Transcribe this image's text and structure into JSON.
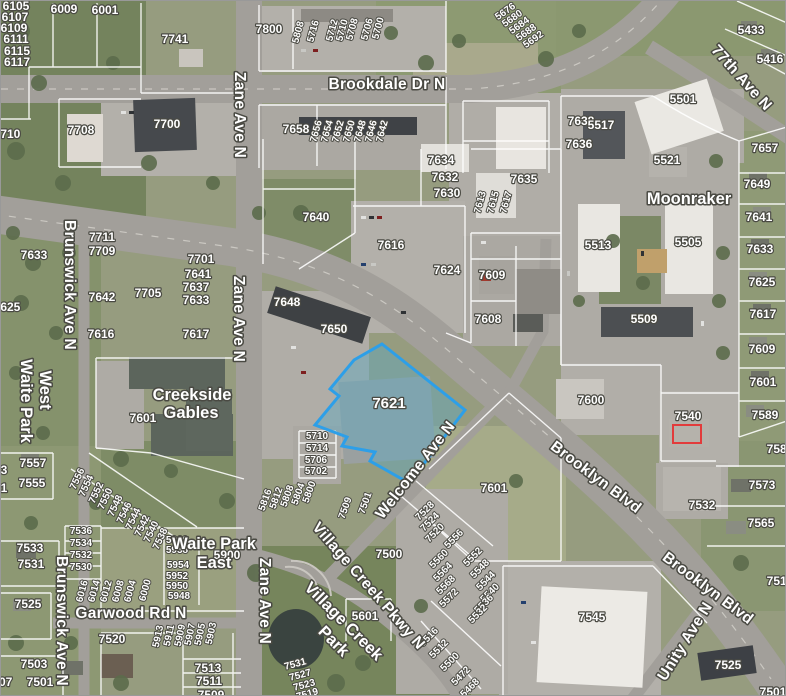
{
  "map": {
    "type": "aerial-parcel-map",
    "selected_parcel": {
      "id": "7621",
      "outline_color": "#2d9fe8",
      "fill_color": "#5fa8c0"
    },
    "red_outline": {
      "near_parcel": "7540",
      "color": "#e23b3b"
    },
    "colors": {
      "label_text": "#ffffff",
      "label_halo": "#4a4a43",
      "parcel_line": "#ffffff"
    },
    "street_labels": [
      {
        "t": "Brookdale Dr N",
        "x": 386,
        "y": 88,
        "r": 0
      },
      {
        "t": "Zane Ave N",
        "x": 234,
        "y": 114,
        "r": 90
      },
      {
        "t": "Zane Ave N",
        "x": 233,
        "y": 318,
        "r": 90
      },
      {
        "t": "Zane Ave N",
        "x": 259,
        "y": 600,
        "r": 90
      },
      {
        "t": "Brunswick Ave N",
        "x": 64,
        "y": 284,
        "r": 90
      },
      {
        "t": "Brunswick Ave N",
        "x": 56,
        "y": 620,
        "r": 90
      },
      {
        "t": "Brooklyn Blvd",
        "x": 592,
        "y": 480,
        "r": 37
      },
      {
        "t": "Brooklyn Blvd",
        "x": 704,
        "y": 591,
        "r": 37
      },
      {
        "t": "Welcome Ave N",
        "x": 418,
        "y": 472,
        "r": -52
      },
      {
        "t": "Village Creek Pkwy N",
        "x": 364,
        "y": 588,
        "r": 49
      },
      {
        "t": "Unity Ave N",
        "x": 688,
        "y": 643,
        "r": -58
      },
      {
        "t": "77th Ave N",
        "x": 737,
        "y": 80,
        "r": 48
      },
      {
        "t": "Garwood Rd N",
        "x": 130,
        "y": 617,
        "r": 0
      }
    ],
    "area_labels": [
      {
        "t": "Moonraker",
        "x": 688,
        "y": 203,
        "r": 0
      },
      {
        "t": "Creekside",
        "x": 191,
        "y": 399,
        "r": 0
      },
      {
        "t": "Gables",
        "x": 190,
        "y": 417,
        "r": 0
      },
      {
        "t": "Waite Park",
        "x": 20,
        "y": 400,
        "r": 90
      },
      {
        "t": "West",
        "x": 39,
        "y": 389,
        "r": 90
      },
      {
        "t": "Waite Park",
        "x": 213,
        "y": 548,
        "r": 0
      },
      {
        "t": "East",
        "x": 213,
        "y": 567,
        "r": 0
      },
      {
        "t": "Village Creek",
        "x": 339,
        "y": 624,
        "r": 45
      },
      {
        "t": "Park",
        "x": 329,
        "y": 644,
        "r": 45
      }
    ],
    "parcel_labels": [
      {
        "t": "6105",
        "x": 15,
        "y": 9
      },
      {
        "t": "6107",
        "x": 14,
        "y": 20
      },
      {
        "t": "6109",
        "x": 13,
        "y": 31
      },
      {
        "t": "6111",
        "x": 15,
        "y": 42
      },
      {
        "t": "6115",
        "x": 16,
        "y": 54
      },
      {
        "t": "6117",
        "x": 16,
        "y": 65
      },
      {
        "t": "6009",
        "x": 63,
        "y": 12
      },
      {
        "t": "6001",
        "x": 104,
        "y": 13
      },
      {
        "t": "7741",
        "x": 174,
        "y": 42
      },
      {
        "t": "7800",
        "x": 268,
        "y": 32
      },
      {
        "t": "5808",
        "x": 300,
        "y": 32,
        "r": -75,
        "sm": true
      },
      {
        "t": "5716",
        "x": 315,
        "y": 31,
        "r": -75,
        "sm": true
      },
      {
        "t": "5712",
        "x": 334,
        "y": 30,
        "r": -75,
        "sm": true
      },
      {
        "t": "5710",
        "x": 344,
        "y": 30,
        "r": -75,
        "sm": true
      },
      {
        "t": "5708",
        "x": 354,
        "y": 29,
        "r": -75,
        "sm": true
      },
      {
        "t": "5706",
        "x": 369,
        "y": 29,
        "r": -75,
        "sm": true
      },
      {
        "t": "5700",
        "x": 380,
        "y": 28,
        "r": -75,
        "sm": true
      },
      {
        "t": "5676",
        "x": 506,
        "y": 13,
        "r": -35,
        "sm": true
      },
      {
        "t": "5680",
        "x": 513,
        "y": 20,
        "r": -35,
        "sm": true
      },
      {
        "t": "5684",
        "x": 520,
        "y": 27,
        "r": -35,
        "sm": true
      },
      {
        "t": "5688",
        "x": 527,
        "y": 34,
        "r": -35,
        "sm": true
      },
      {
        "t": "5692",
        "x": 534,
        "y": 41,
        "r": -35,
        "sm": true
      },
      {
        "t": "5433",
        "x": 750,
        "y": 33
      },
      {
        "t": "5416",
        "x": 769,
        "y": 62
      },
      {
        "t": "7708",
        "x": 80,
        "y": 133
      },
      {
        "t": "7710",
        "x": 6,
        "y": 137
      },
      {
        "t": "7700",
        "x": 166,
        "y": 127
      },
      {
        "t": "7658",
        "x": 295,
        "y": 132
      },
      {
        "t": "7656",
        "x": 318,
        "y": 131,
        "r": -75,
        "sm": true
      },
      {
        "t": "7654",
        "x": 329,
        "y": 131,
        "r": -75,
        "sm": true
      },
      {
        "t": "7652",
        "x": 340,
        "y": 131,
        "r": -75,
        "sm": true
      },
      {
        "t": "7650",
        "x": 351,
        "y": 131,
        "r": -75,
        "sm": true
      },
      {
        "t": "7648",
        "x": 362,
        "y": 131,
        "r": -75,
        "sm": true
      },
      {
        "t": "7646",
        "x": 373,
        "y": 131,
        "r": -75,
        "sm": true
      },
      {
        "t": "7642",
        "x": 384,
        "y": 131,
        "r": -75,
        "sm": true
      },
      {
        "t": "7638",
        "x": 580,
        "y": 124
      },
      {
        "t": "7636",
        "x": 578,
        "y": 147
      },
      {
        "t": "7634",
        "x": 440,
        "y": 163
      },
      {
        "t": "7632",
        "x": 444,
        "y": 180
      },
      {
        "t": "7630",
        "x": 446,
        "y": 196
      },
      {
        "t": "7635",
        "x": 523,
        "y": 182
      },
      {
        "t": "7613",
        "x": 482,
        "y": 202,
        "r": -75,
        "sm": true
      },
      {
        "t": "7615",
        "x": 495,
        "y": 202,
        "r": -75,
        "sm": true
      },
      {
        "t": "7617",
        "x": 508,
        "y": 202,
        "r": -75,
        "sm": true
      },
      {
        "t": "7640",
        "x": 315,
        "y": 220
      },
      {
        "t": "7616",
        "x": 390,
        "y": 248
      },
      {
        "t": "7624",
        "x": 446,
        "y": 273
      },
      {
        "t": "7609",
        "x": 491,
        "y": 278
      },
      {
        "t": "7608",
        "x": 487,
        "y": 322
      },
      {
        "t": "7648",
        "x": 286,
        "y": 305
      },
      {
        "t": "7650",
        "x": 333,
        "y": 332
      },
      {
        "t": "5501",
        "x": 682,
        "y": 102
      },
      {
        "t": "5517",
        "x": 600,
        "y": 128
      },
      {
        "t": "5521",
        "x": 666,
        "y": 163
      },
      {
        "t": "5513",
        "x": 597,
        "y": 248
      },
      {
        "t": "5505",
        "x": 687,
        "y": 245
      },
      {
        "t": "5509",
        "x": 643,
        "y": 322
      },
      {
        "t": "7657",
        "x": 764,
        "y": 151
      },
      {
        "t": "7649",
        "x": 756,
        "y": 187
      },
      {
        "t": "7641",
        "x": 758,
        "y": 220
      },
      {
        "t": "7633",
        "x": 759,
        "y": 252
      },
      {
        "t": "7625",
        "x": 761,
        "y": 285
      },
      {
        "t": "7617",
        "x": 762,
        "y": 317
      },
      {
        "t": "7609",
        "x": 761,
        "y": 352
      },
      {
        "t": "7601",
        "x": 762,
        "y": 385
      },
      {
        "t": "7589",
        "x": 764,
        "y": 418
      },
      {
        "t": "7581",
        "x": 779,
        "y": 452
      },
      {
        "t": "7573",
        "x": 761,
        "y": 488
      },
      {
        "t": "7565",
        "x": 760,
        "y": 526
      },
      {
        "t": "7517",
        "x": 779,
        "y": 584
      },
      {
        "t": "7600",
        "x": 590,
        "y": 403
      },
      {
        "t": "7540",
        "x": 687,
        "y": 419
      },
      {
        "t": "7711",
        "x": 101,
        "y": 240
      },
      {
        "t": "7709",
        "x": 101,
        "y": 254
      },
      {
        "t": "7642",
        "x": 101,
        "y": 300
      },
      {
        "t": "7705",
        "x": 147,
        "y": 296
      },
      {
        "t": "7616",
        "x": 100,
        "y": 337
      },
      {
        "t": "7701",
        "x": 200,
        "y": 262
      },
      {
        "t": "7641",
        "x": 197,
        "y": 277
      },
      {
        "t": "7637",
        "x": 195,
        "y": 290
      },
      {
        "t": "7633",
        "x": 195,
        "y": 303
      },
      {
        "t": "7617",
        "x": 195,
        "y": 337
      },
      {
        "t": "7633",
        "x": 33,
        "y": 258
      },
      {
        "t": "7625",
        "x": 6,
        "y": 310
      },
      {
        "t": "7557",
        "x": 32,
        "y": 466
      },
      {
        "t": "7555",
        "x": 31,
        "y": 486
      },
      {
        "t": "7553",
        "x": -7,
        "y": 473
      },
      {
        "t": "7551",
        "x": -7,
        "y": 491
      },
      {
        "t": "7601",
        "x": 142,
        "y": 421
      },
      {
        "t": "7556",
        "x": 79,
        "y": 479,
        "r": -65,
        "sm": true
      },
      {
        "t": "7554",
        "x": 88,
        "y": 486,
        "r": -65,
        "sm": true
      },
      {
        "t": "7552",
        "x": 98,
        "y": 493,
        "r": -65,
        "sm": true
      },
      {
        "t": "7550",
        "x": 107,
        "y": 499,
        "r": -65,
        "sm": true
      },
      {
        "t": "7548",
        "x": 117,
        "y": 506,
        "r": -65,
        "sm": true
      },
      {
        "t": "7546",
        "x": 126,
        "y": 513,
        "r": -65,
        "sm": true
      },
      {
        "t": "7544",
        "x": 135,
        "y": 519,
        "r": -65,
        "sm": true
      },
      {
        "t": "7542",
        "x": 144,
        "y": 526,
        "r": -65,
        "sm": true
      },
      {
        "t": "7540",
        "x": 153,
        "y": 532,
        "r": -65,
        "sm": true
      },
      {
        "t": "7538",
        "x": 162,
        "y": 539,
        "r": -65,
        "sm": true
      },
      {
        "t": "7536",
        "x": 80,
        "y": 533,
        "sm": true
      },
      {
        "t": "7534",
        "x": 80,
        "y": 545,
        "sm": true
      },
      {
        "t": "7532",
        "x": 80,
        "y": 557,
        "sm": true
      },
      {
        "t": "7530",
        "x": 80,
        "y": 569,
        "sm": true
      },
      {
        "t": "7533",
        "x": 29,
        "y": 551
      },
      {
        "t": "7531",
        "x": 30,
        "y": 567
      },
      {
        "t": "7525",
        "x": 27,
        "y": 607
      },
      {
        "t": "7503",
        "x": 33,
        "y": 667
      },
      {
        "t": "7501",
        "x": 39,
        "y": 685
      },
      {
        "t": "7507",
        "x": -2,
        "y": 685
      },
      {
        "t": "5960",
        "x": 176,
        "y": 542,
        "sm": true
      },
      {
        "t": "5958",
        "x": 176,
        "y": 552,
        "sm": true
      },
      {
        "t": "5954",
        "x": 177,
        "y": 567,
        "sm": true
      },
      {
        "t": "5952",
        "x": 176,
        "y": 578,
        "sm": true
      },
      {
        "t": "5950",
        "x": 176,
        "y": 588,
        "sm": true
      },
      {
        "t": "5948",
        "x": 178,
        "y": 598,
        "sm": true
      },
      {
        "t": "5900",
        "x": 226,
        "y": 558
      },
      {
        "t": "6016",
        "x": 84,
        "y": 591,
        "r": -75,
        "sm": true
      },
      {
        "t": "6014",
        "x": 96,
        "y": 591,
        "r": -75,
        "sm": true
      },
      {
        "t": "6012",
        "x": 108,
        "y": 591,
        "r": -75,
        "sm": true
      },
      {
        "t": "6008",
        "x": 120,
        "y": 591,
        "r": -75,
        "sm": true
      },
      {
        "t": "6004",
        "x": 132,
        "y": 591,
        "r": -75,
        "sm": true
      },
      {
        "t": "6000",
        "x": 147,
        "y": 590,
        "r": -75,
        "sm": true
      },
      {
        "t": "5913",
        "x": 160,
        "y": 636,
        "r": -78,
        "sm": true
      },
      {
        "t": "5911",
        "x": 171,
        "y": 635,
        "r": -78,
        "sm": true
      },
      {
        "t": "5909",
        "x": 182,
        "y": 635,
        "r": -78,
        "sm": true
      },
      {
        "t": "5907",
        "x": 192,
        "y": 634,
        "r": -78,
        "sm": true
      },
      {
        "t": "5905",
        "x": 202,
        "y": 634,
        "r": -78,
        "sm": true
      },
      {
        "t": "5903",
        "x": 213,
        "y": 633,
        "r": -78,
        "sm": true
      },
      {
        "t": "7520",
        "x": 111,
        "y": 642
      },
      {
        "t": "7513",
        "x": 207,
        "y": 671
      },
      {
        "t": "7511",
        "x": 208,
        "y": 684
      },
      {
        "t": "7509",
        "x": 210,
        "y": 698
      },
      {
        "t": "5816",
        "x": 267,
        "y": 500,
        "r": -70,
        "sm": true
      },
      {
        "t": "5812",
        "x": 278,
        "y": 498,
        "r": -70,
        "sm": true
      },
      {
        "t": "5808",
        "x": 289,
        "y": 496,
        "r": -70,
        "sm": true
      },
      {
        "t": "5804",
        "x": 300,
        "y": 494,
        "r": -70,
        "sm": true
      },
      {
        "t": "5800",
        "x": 311,
        "y": 492,
        "r": -70,
        "sm": true
      },
      {
        "t": "7509",
        "x": 347,
        "y": 508,
        "r": -70,
        "sm": true
      },
      {
        "t": "7501",
        "x": 367,
        "y": 503,
        "r": -70,
        "sm": true
      },
      {
        "t": "7500",
        "x": 388,
        "y": 557
      },
      {
        "t": "7528",
        "x": 426,
        "y": 512,
        "r": -45,
        "sm": true
      },
      {
        "t": "7524",
        "x": 431,
        "y": 523,
        "r": -45,
        "sm": true
      },
      {
        "t": "7520",
        "x": 436,
        "y": 534,
        "r": -45,
        "sm": true
      },
      {
        "t": "5560",
        "x": 440,
        "y": 560,
        "r": -45,
        "sm": true
      },
      {
        "t": "5564",
        "x": 444,
        "y": 573,
        "r": -45,
        "sm": true
      },
      {
        "t": "5568",
        "x": 447,
        "y": 586,
        "r": -45,
        "sm": true
      },
      {
        "t": "5572",
        "x": 450,
        "y": 599,
        "r": -45,
        "sm": true
      },
      {
        "t": "5556",
        "x": 455,
        "y": 540,
        "r": -45,
        "sm": true
      },
      {
        "t": "5552",
        "x": 474,
        "y": 558,
        "r": -45,
        "sm": true
      },
      {
        "t": "5548",
        "x": 481,
        "y": 570,
        "r": -45,
        "sm": true
      },
      {
        "t": "5544",
        "x": 487,
        "y": 582,
        "r": -45,
        "sm": true
      },
      {
        "t": "5540",
        "x": 491,
        "y": 594,
        "r": -45,
        "sm": true
      },
      {
        "t": "5536",
        "x": 485,
        "y": 605,
        "r": -45,
        "sm": true
      },
      {
        "t": "5532",
        "x": 479,
        "y": 615,
        "r": -45,
        "sm": true
      },
      {
        "t": "5516",
        "x": 430,
        "y": 638,
        "r": -45,
        "sm": true
      },
      {
        "t": "5512",
        "x": 440,
        "y": 650,
        "r": -45,
        "sm": true
      },
      {
        "t": "5500",
        "x": 451,
        "y": 663,
        "r": -45,
        "sm": true
      },
      {
        "t": "5472",
        "x": 462,
        "y": 677,
        "r": -45,
        "sm": true
      },
      {
        "t": "5468",
        "x": 471,
        "y": 689,
        "r": -45,
        "sm": true
      },
      {
        "t": "7531",
        "x": 295,
        "y": 666,
        "r": -15,
        "sm": true
      },
      {
        "t": "7527",
        "x": 300,
        "y": 677,
        "r": -15,
        "sm": true
      },
      {
        "t": "7523",
        "x": 304,
        "y": 687,
        "r": -15,
        "sm": true
      },
      {
        "t": "7519",
        "x": 307,
        "y": 696,
        "r": -15,
        "sm": true
      },
      {
        "t": "5601",
        "x": 364,
        "y": 619
      },
      {
        "t": "7601",
        "x": 493,
        "y": 491
      },
      {
        "t": "7532",
        "x": 701,
        "y": 508
      },
      {
        "t": "7545",
        "x": 591,
        "y": 620
      },
      {
        "t": "7525",
        "x": 727,
        "y": 668
      },
      {
        "t": "7501",
        "x": 772,
        "y": 695
      },
      {
        "t": "5710",
        "x": 316,
        "y": 438,
        "sm": true
      },
      {
        "t": "5714",
        "x": 316,
        "y": 450,
        "sm": true
      },
      {
        "t": "5706",
        "x": 315,
        "y": 462,
        "sm": true
      },
      {
        "t": "5702",
        "x": 315,
        "y": 473,
        "sm": true
      }
    ]
  }
}
